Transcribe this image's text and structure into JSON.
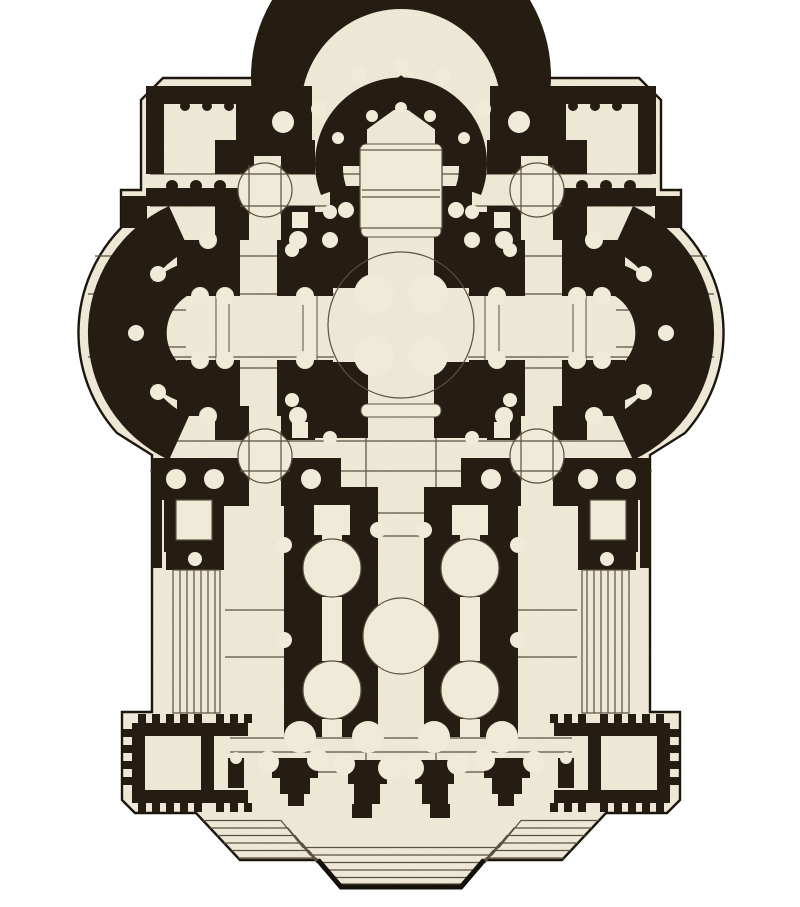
{
  "figure": {
    "name": "basilica-floor-plan",
    "kind": "engraved architectural floor plan",
    "description_parts": {
      "center": "domed-crossing",
      "top": "apse-with-ambulatory",
      "left": "transept-apse",
      "right": "transept-apse",
      "bottom": "nave-portico-and-steps"
    }
  },
  "palette": {
    "background": "#ffffff",
    "parchment": "#f0ead9",
    "wall": "#251d12",
    "line": "#5a5140",
    "outline": "#1a140c",
    "shadow": "#14100a"
  }
}
